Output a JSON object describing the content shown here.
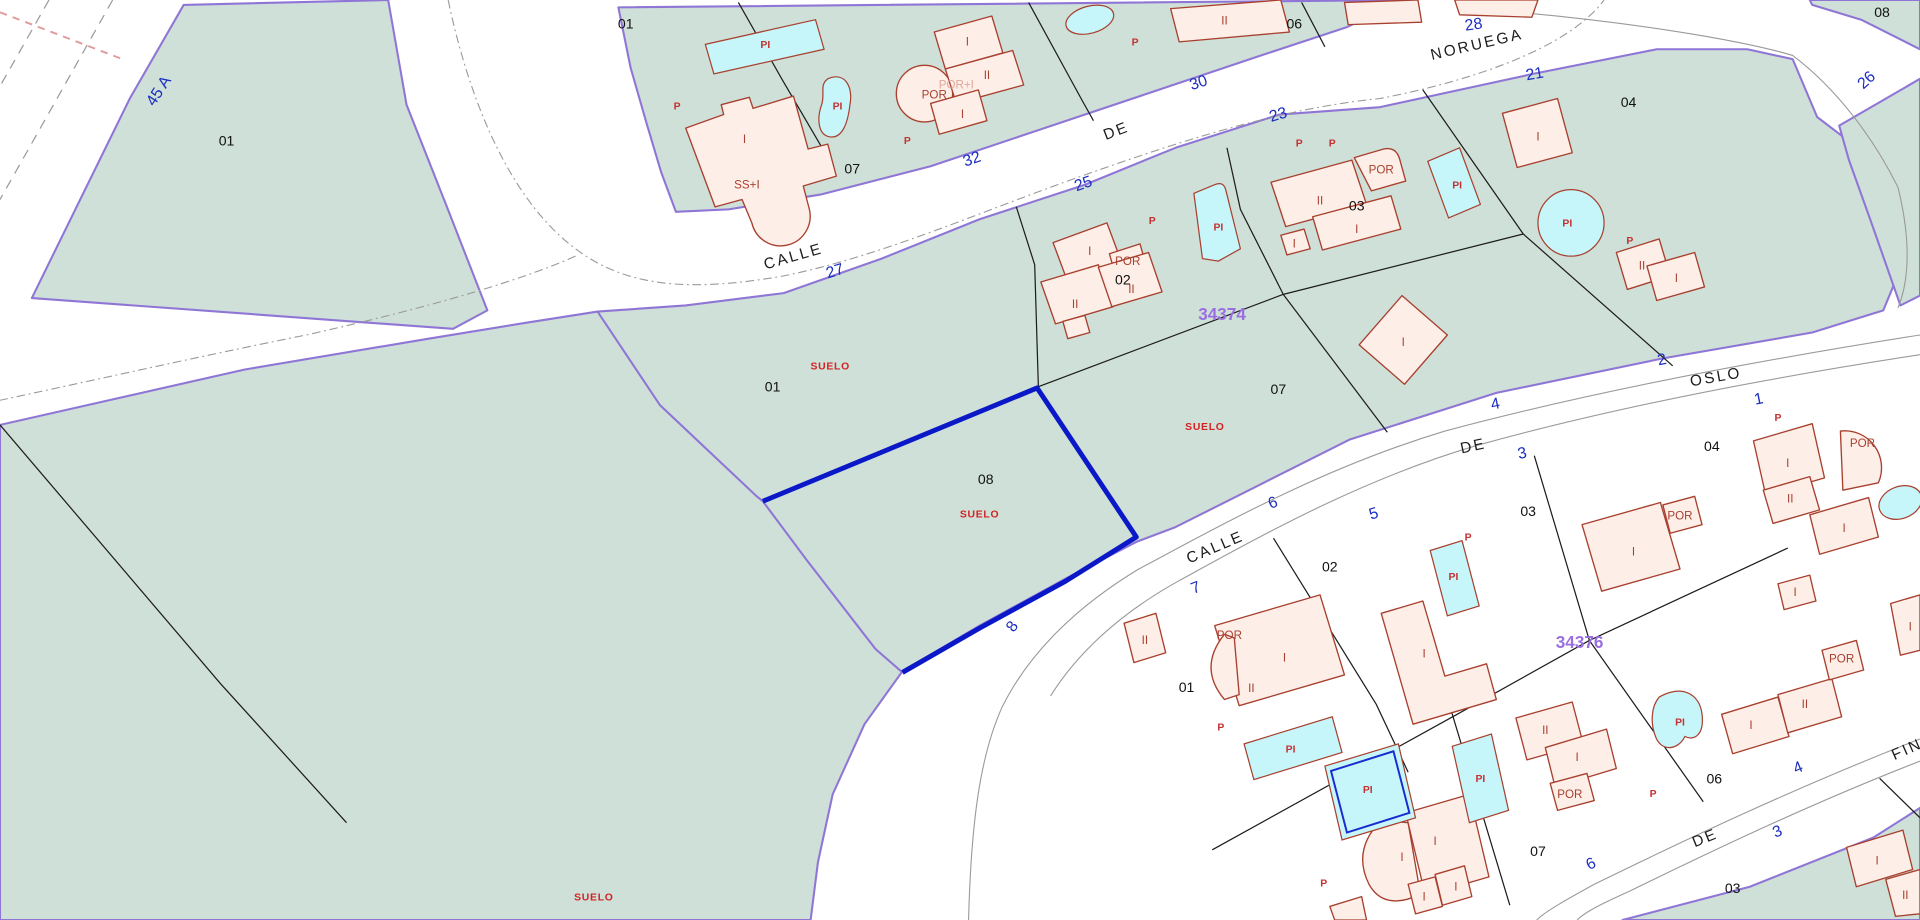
{
  "map_title": "Cadastral parcel map",
  "selected_parc<!---->el": "08",
  "colors": {
    "parcel_fill": "#cfe0d8",
    "parcel_border": "#8f76d6",
    "building_fill": "#fdeee8",
    "building_border": "#a8402f",
    "pool_fill": "#c6f6f9",
    "selected_border": "#0a18c8",
    "street_number": "#1b2ec0",
    "block_number": "#9a6fe0",
    "red_label": "#d42222"
  },
  "labels": {
    "street_names": [
      {
        "t": "CALLE",
        "x": 649,
        "y": 212,
        "r": -16
      },
      {
        "t": "DE",
        "x": 913,
        "y": 110,
        "r": -21
      },
      {
        "t": "NORUEGA",
        "x": 1207,
        "y": 40,
        "r": -13
      },
      {
        "t": "OSLO",
        "x": 1402,
        "y": 310,
        "r": -10
      },
      {
        "t": "DE",
        "x": 1204,
        "y": 366,
        "r": -12
      },
      {
        "t": "CALLE",
        "x": 994,
        "y": 448,
        "r": -23
      },
      {
        "t": "DE",
        "x": 1394,
        "y": 684,
        "r": -22
      },
      {
        "t": "FIN",
        "x": 1559,
        "y": 612,
        "r": -24
      }
    ],
    "street_numbers": [
      {
        "t": "45 A",
        "x": 133,
        "y": 76,
        "r": -57
      },
      {
        "t": "27",
        "x": 683,
        "y": 224,
        "r": -17
      },
      {
        "t": "32",
        "x": 795,
        "y": 133,
        "r": -19
      },
      {
        "t": "25",
        "x": 886,
        "y": 153,
        "r": -19
      },
      {
        "t": "30",
        "x": 980,
        "y": 71,
        "r": -18
      },
      {
        "t": "23",
        "x": 1045,
        "y": 97,
        "r": -17
      },
      {
        "t": "28",
        "x": 1204,
        "y": 24,
        "r": -8
      },
      {
        "t": "21",
        "x": 1254,
        "y": 64,
        "r": -10
      },
      {
        "t": "26",
        "x": 1527,
        "y": 68,
        "r": -42
      },
      {
        "t": "2",
        "x": 1358,
        "y": 296,
        "r": -11
      },
      {
        "t": "4",
        "x": 1222,
        "y": 332,
        "r": -12
      },
      {
        "t": "1",
        "x": 1437,
        "y": 328,
        "r": -11
      },
      {
        "t": "3",
        "x": 1244,
        "y": 372,
        "r": -12
      },
      {
        "t": "6",
        "x": 1041,
        "y": 412,
        "r": -21
      },
      {
        "t": "5",
        "x": 1123,
        "y": 421,
        "r": -17
      },
      {
        "t": "7",
        "x": 978,
        "y": 481,
        "r": -21
      },
      {
        "t": "8",
        "x": 830,
        "y": 511,
        "r": -55
      },
      {
        "t": "4",
        "x": 1470,
        "y": 627,
        "r": -23
      },
      {
        "t": "3",
        "x": 1453,
        "y": 679,
        "r": -22
      },
      {
        "t": "6",
        "x": 1301,
        "y": 705,
        "r": -26
      }
    ],
    "parcel_numbers": [
      {
        "t": "01",
        "x": 185,
        "y": 118
      },
      {
        "t": "01",
        "x": 511,
        "y": 23
      },
      {
        "t": "07",
        "x": 696,
        "y": 141
      },
      {
        "t": "06",
        "x": 1057,
        "y": 23
      },
      {
        "t": "08",
        "x": 1537,
        "y": 14
      },
      {
        "t": "04",
        "x": 1330,
        "y": 87
      },
      {
        "t": "02",
        "x": 917,
        "y": 231
      },
      {
        "t": "03",
        "x": 1108,
        "y": 171
      },
      {
        "t": "07",
        "x": 1044,
        "y": 320
      },
      {
        "t": "01",
        "x": 631,
        "y": 318
      },
      {
        "t": "08",
        "x": 805,
        "y": 393
      },
      {
        "t": "02",
        "x": 1086,
        "y": 464
      },
      {
        "t": "03",
        "x": 1248,
        "y": 419
      },
      {
        "t": "04",
        "x": 1398,
        "y": 366
      },
      {
        "t": "01",
        "x": 969,
        "y": 562
      },
      {
        "t": "06",
        "x": 1400,
        "y": 636
      },
      {
        "t": "07",
        "x": 1256,
        "y": 695
      },
      {
        "t": "03",
        "x": 1415,
        "y": 725
      }
    ],
    "block_numbers": [
      {
        "t": "34374",
        "x": 998,
        "y": 260
      },
      {
        "t": "34376",
        "x": 1290,
        "y": 526
      }
    ],
    "suelo_labels": [
      {
        "t": "SUELO",
        "x": 678,
        "y": 300
      },
      {
        "t": "SUELO",
        "x": 800,
        "y": 420
      },
      {
        "t": "SUELO",
        "x": 984,
        "y": 349
      },
      {
        "t": "SUELO",
        "x": 485,
        "y": 731
      }
    ],
    "p_labels": [
      {
        "t": "P",
        "x": 553,
        "y": 89
      },
      {
        "t": "P",
        "x": 741,
        "y": 117
      },
      {
        "t": "P",
        "x": 927,
        "y": 37
      },
      {
        "t": "P",
        "x": 1061,
        "y": 119
      },
      {
        "t": "P",
        "x": 941,
        "y": 182
      },
      {
        "t": "P",
        "x": 1088,
        "y": 119
      },
      {
        "t": "P",
        "x": 1331,
        "y": 198
      },
      {
        "t": "P",
        "x": 1452,
        "y": 342
      },
      {
        "t": "P",
        "x": 1199,
        "y": 439
      },
      {
        "t": "P",
        "x": 1350,
        "y": 647
      },
      {
        "t": "P",
        "x": 997,
        "y": 593
      },
      {
        "t": "P",
        "x": 1081,
        "y": 720
      }
    ],
    "building_labels": [
      {
        "t": "I",
        "x": 608,
        "y": 116
      },
      {
        "t": "SS+I",
        "x": 610,
        "y": 153
      },
      {
        "t": "I",
        "x": 790,
        "y": 37
      },
      {
        "t": "II",
        "x": 806,
        "y": 64
      },
      {
        "t": "I",
        "x": 786,
        "y": 96
      },
      {
        "t": "POR",
        "x": 763,
        "y": 80
      },
      {
        "t": "II",
        "x": 1000,
        "y": 20
      },
      {
        "t": "I",
        "x": 890,
        "y": 207
      },
      {
        "t": "POR",
        "x": 921,
        "y": 215
      },
      {
        "t": "II",
        "x": 878,
        "y": 250
      },
      {
        "t": "II",
        "x": 924,
        "y": 238
      },
      {
        "t": "II",
        "x": 1078,
        "y": 166
      },
      {
        "t": "POR",
        "x": 1128,
        "y": 141
      },
      {
        "t": "I",
        "x": 1108,
        "y": 189
      },
      {
        "t": "I",
        "x": 1057,
        "y": 201
      },
      {
        "t": "I",
        "x": 1256,
        "y": 114
      },
      {
        "t": "II",
        "x": 1341,
        "y": 219
      },
      {
        "t": "I",
        "x": 1369,
        "y": 229
      },
      {
        "t": "I",
        "x": 1146,
        "y": 281
      },
      {
        "t": "II",
        "x": 935,
        "y": 523
      },
      {
        "t": "POR",
        "x": 1004,
        "y": 519
      },
      {
        "t": "I",
        "x": 1049,
        "y": 537
      },
      {
        "t": "II",
        "x": 1022,
        "y": 562
      },
      {
        "t": "I",
        "x": 1163,
        "y": 534
      },
      {
        "t": "I",
        "x": 1334,
        "y": 451
      },
      {
        "t": "POR",
        "x": 1372,
        "y": 422
      },
      {
        "t": "I",
        "x": 1460,
        "y": 379
      },
      {
        "t": "II",
        "x": 1462,
        "y": 408
      },
      {
        "t": "I",
        "x": 1506,
        "y": 432
      },
      {
        "t": "POR",
        "x": 1521,
        "y": 363
      },
      {
        "t": "I",
        "x": 1466,
        "y": 484
      },
      {
        "t": "I",
        "x": 1560,
        "y": 512
      },
      {
        "t": "II",
        "x": 1262,
        "y": 596
      },
      {
        "t": "I",
        "x": 1288,
        "y": 618
      },
      {
        "t": "POR",
        "x": 1282,
        "y": 648
      },
      {
        "t": "I",
        "x": 1430,
        "y": 592
      },
      {
        "t": "II",
        "x": 1474,
        "y": 575
      },
      {
        "t": "POR",
        "x": 1504,
        "y": 538
      },
      {
        "t": "I",
        "x": 1145,
        "y": 699
      },
      {
        "t": "I",
        "x": 1172,
        "y": 686
      },
      {
        "t": "I",
        "x": 1163,
        "y": 731
      },
      {
        "t": "I",
        "x": 1189,
        "y": 723
      },
      {
        "t": "I",
        "x": 1533,
        "y": 702
      },
      {
        "t": "II",
        "x": 1556,
        "y": 730
      }
    ],
    "building_labels_light": [
      {
        "t": "POR+I",
        "x": 781,
        "y": 72
      }
    ],
    "pool_labels": [
      {
        "t": "PI",
        "x": 625,
        "y": 39
      },
      {
        "t": "PI",
        "x": 684,
        "y": 89
      },
      {
        "t": "PI",
        "x": 995,
        "y": 187
      },
      {
        "t": "PI",
        "x": 1190,
        "y": 153
      },
      {
        "t": "PI",
        "x": 1280,
        "y": 184
      },
      {
        "t": "PI",
        "x": 1054,
        "y": 611
      },
      {
        "t": "PI",
        "x": 1187,
        "y": 471
      },
      {
        "t": "PI",
        "x": 1117,
        "y": 644
      },
      {
        "t": "PI",
        "x": 1209,
        "y": 635
      },
      {
        "t": "PI",
        "x": 1372,
        "y": 589
      }
    ]
  }
}
